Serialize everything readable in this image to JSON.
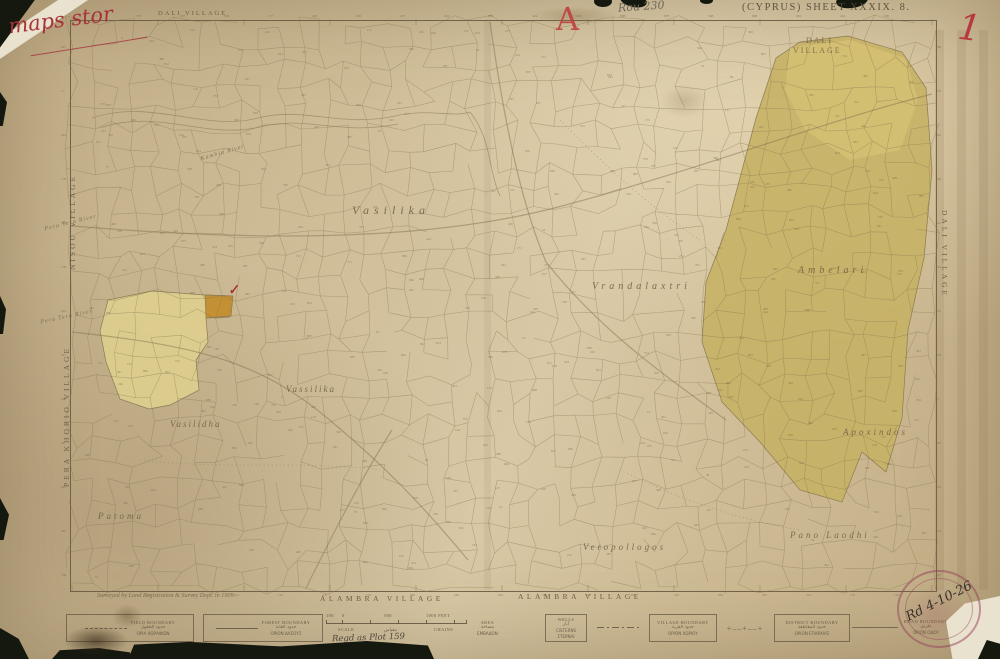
{
  "meta": {
    "sheet_title": "(CYPRUS)  SHEET   XXXIX.  8."
  },
  "colors": {
    "backing": "#14170e",
    "line": "#84734f",
    "number": "#6d5d42",
    "accent_red": "#a8323a",
    "khaki": "#c7b165",
    "pale_yellow": "#decf8e",
    "orange": "#c18c2e",
    "stamp": "#963e5c"
  },
  "annotations": {
    "red_script": "maps stor",
    "pencil_note": "Rou 230",
    "red_letter": "A",
    "red_numeral": "1",
    "check_mark": "✓",
    "stamp_handwriting": "Rd 4-10-26",
    "regd_note": "Regd as Plot 159"
  },
  "edge_labels": {
    "top": "DALI VILLAGE",
    "left_upper": "NISOU VILLAGE",
    "left_lower": "PERA KHORIO VILLAGE",
    "right": "DALI VILLAGE",
    "bottom_left": "ALAMBRA VILLAGE",
    "bottom_right": "ALAMBRA VILLAGE"
  },
  "footer": {
    "surveyed": "Surveyed by Land Registration & Survey Dept. in 1909."
  },
  "map_labels": [
    {
      "t": "Vasilika",
      "x": 352,
      "y": 203,
      "s": 12,
      "ls": 5,
      "cls": "loc"
    },
    {
      "t": "Vrandalaxtri",
      "x": 592,
      "y": 281,
      "s": 10,
      "ls": 4,
      "cls": "loc"
    },
    {
      "t": "Ambelari",
      "x": 798,
      "y": 265,
      "s": 10,
      "ls": 4,
      "cls": "loc"
    },
    {
      "t": "Apoxindos",
      "x": 843,
      "y": 427,
      "s": 9,
      "ls": 3,
      "cls": "loc"
    },
    {
      "t": "Vassilika",
      "x": 286,
      "y": 384,
      "s": 9,
      "ls": 2,
      "cls": "loc"
    },
    {
      "t": "Vasilidha",
      "x": 170,
      "y": 419,
      "s": 9,
      "ls": 2,
      "cls": "loc"
    },
    {
      "t": "Patoma",
      "x": 98,
      "y": 511,
      "s": 9,
      "ls": 3,
      "cls": "loc"
    },
    {
      "t": "Veropollogos",
      "x": 583,
      "y": 542,
      "s": 9,
      "ls": 3,
      "cls": "loc"
    },
    {
      "t": "Pano Laodhi",
      "x": 790,
      "y": 530,
      "s": 9,
      "ls": 3,
      "cls": "loc"
    },
    {
      "t": "DALI",
      "x": 806,
      "y": 36,
      "s": 8,
      "ls": 2,
      "cls": "vilcap"
    },
    {
      "t": "VILLAGE",
      "x": 793,
      "y": 46,
      "s": 8,
      "ls": 2,
      "cls": "vilcap"
    },
    {
      "t": "Pera Tera River",
      "x": 44,
      "y": 220,
      "s": 6,
      "rot": -14,
      "cls": "river"
    },
    {
      "t": "Pera Tera River",
      "x": 40,
      "y": 314,
      "s": 6,
      "rot": -12,
      "cls": "river"
    },
    {
      "t": "Kambia River",
      "x": 200,
      "y": 150,
      "s": 6,
      "rot": -16,
      "cls": "river"
    }
  ],
  "legend": {
    "entries": [
      {
        "x": 66,
        "y": 614,
        "w": 126,
        "h": 26,
        "border": true,
        "sym": "dash",
        "lines": [
          "FIELD BOUNDARY",
          "حدود الحقول",
          "ΟΡΙΑ ΧΩΡΑΦΙΩΝ"
        ]
      },
      {
        "x": 203,
        "y": 614,
        "w": 118,
        "h": 26,
        "border": true,
        "sym": "solid",
        "lines": [
          "FOREST BOUNDARY",
          "حدود الغابة",
          "ΟΡΙΟΝ ΔΑΣΟΥΣ"
        ]
      },
      {
        "x": 477,
        "y": 616,
        "w": 50,
        "h": 24,
        "border": false,
        "sym": "none",
        "lines": [
          "AREA",
          "مساحة",
          "ΕΜΒΑΔΟΝ"
        ]
      },
      {
        "x": 545,
        "y": 614,
        "w": 40,
        "h": 26,
        "border": true,
        "sym": "none",
        "lines": [
          "WELLS",
          "آبار",
          "CISTERNS",
          "ΣΤΕΡΝΑΙ"
        ]
      },
      {
        "x": 597,
        "y": 614,
        "w": 118,
        "h": 26,
        "border": true,
        "sym": "dashdot",
        "symOutside": true,
        "lines": [
          "VILLAGE BOUNDARY",
          "حدود القرية",
          "ΟΡΙΟΝ ΧΩΡΙΟΥ"
        ]
      },
      {
        "x": 722,
        "y": 614,
        "w": 126,
        "h": 26,
        "border": true,
        "sym": "crosses",
        "symOutside": true,
        "lines": [
          "DISTRICT BOUNDARY",
          "حدود المقاطعة",
          "ΟΡΙΟΝ ΕΠΑΡΧΙΑΣ"
        ]
      },
      {
        "x": 852,
        "y": 614,
        "w": 100,
        "h": 26,
        "border": false,
        "sym": "line",
        "symOutside": true,
        "lines": [
          "ROAD BOUNDARY",
          "طريق",
          "ΟΡΙΟΝ ΟΔΟΥ"
        ]
      }
    ],
    "crosses_glyphs": "+‒‒+‒‒+",
    "scale": {
      "x": 326,
      "y": 613,
      "w": 140,
      "marks": [
        {
          "t": "100",
          "x": 0
        },
        {
          "t": "0",
          "x": 16
        },
        {
          "t": "500",
          "x": 58
        },
        {
          "t": "1000 FEET",
          "x": 100
        }
      ],
      "ticks": [
        0,
        16,
        44,
        72,
        100,
        128,
        140
      ],
      "belows": [
        {
          "t": "SCALE",
          "x": 12
        },
        {
          "t": "مقياس",
          "x": 58
        },
        {
          "t": "CHAINS",
          "x": 108
        }
      ]
    }
  },
  "regions": [
    {
      "pts": "800,42 848,36 902,52 926,88 932,170 924,258 908,330 902,418 886,472 862,452 842,502 800,490 760,442 722,402 702,342 706,282 726,230 756,118 776,58",
      "fill": "#c7b165",
      "op": 0.9,
      "stroke": "#8b7a54"
    },
    {
      "pts": "790,48 850,40 905,58 918,100 900,150 850,160 805,130 785,90",
      "fill": "#d8c577",
      "op": 0.65,
      "stroke": "none"
    },
    {
      "pts": "108,300 152,291 205,295 231,296 229,317 206,318 208,342 196,360 199,390 170,405 149,409 120,399 106,362 100,331",
      "fill": "#decf8e",
      "op": 0.9,
      "stroke": "#8b7a54"
    },
    {
      "pts": "205,295 233,296 231,316 206,318",
      "fill": "#c18c2e",
      "op": 0.95,
      "stroke": "#8b7a54"
    }
  ],
  "rivers": [
    "M92,118 C150,98 205,132 258,118 C305,106 338,128 395,116 C430,108 452,118 470,112",
    "M100,128 C158,108 206,140 260,127 C306,115 340,136 398,124",
    "M470,112 C492,140 488,170 500,196"
  ],
  "roads": [
    "M72,226 C240,240 420,244 562,206 C704,168 822,122 932,94",
    "M72,332 C200,346 262,362 332,422 C382,464 420,502 468,560",
    "M490,22 C504,120 520,200 546,262 C600,330 660,372 726,420",
    "M306,588 C330,540 360,480 392,430"
  ],
  "trails": [
    "M140,460 C220,470 300,460 380,470",
    "M560,120 C600,160 640,200 700,240",
    "M620,470 C680,500 740,520 800,530"
  ],
  "texture": {
    "seed": 7,
    "area": {
      "x": 72,
      "y": 22,
      "w": 861,
      "h": 566
    },
    "cols": 41,
    "rows": 27,
    "jitter": 7,
    "drop": 0.2,
    "numbers": 320,
    "number_min": 1,
    "number_max": 999,
    "border_number_step": 44
  }
}
